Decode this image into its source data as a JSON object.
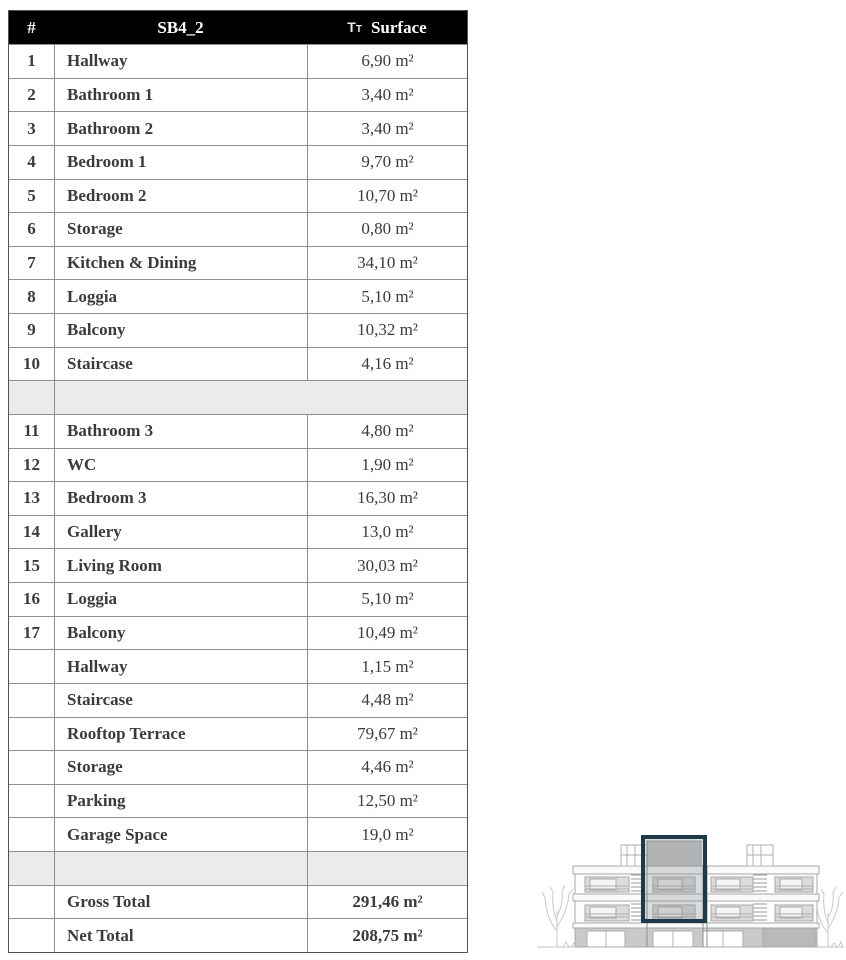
{
  "table": {
    "header": {
      "num": "#",
      "name": "SB4_2",
      "icon_big": "T",
      "icon_small": "T",
      "surface": "Surface"
    },
    "rows": [
      {
        "kind": "normal",
        "num": "1",
        "name": "Hallway",
        "surface": "6,90 m²"
      },
      {
        "kind": "normal",
        "num": "2",
        "name": "Bathroom 1",
        "surface": "3,40 m²"
      },
      {
        "kind": "normal",
        "num": "3",
        "name": "Bathroom 2",
        "surface": "3,40 m²"
      },
      {
        "kind": "normal",
        "num": "4",
        "name": "Bedroom 1",
        "surface": "9,70 m²"
      },
      {
        "kind": "normal",
        "num": "5",
        "name": "Bedroom 2",
        "surface": "10,70 m²"
      },
      {
        "kind": "normal",
        "num": "6",
        "name": "Storage",
        "surface": "0,80 m²"
      },
      {
        "kind": "normal",
        "num": "7",
        "name": "Kitchen & Dining",
        "surface": "34,10 m²"
      },
      {
        "kind": "normal",
        "num": "8",
        "name": "Loggia",
        "surface": "5,10 m²"
      },
      {
        "kind": "normal",
        "num": "9",
        "name": "Balcony",
        "surface": "10,32 m²"
      },
      {
        "kind": "normal",
        "num": "10",
        "name": "Staircase",
        "surface": "4,16 m²"
      },
      {
        "kind": "spacer",
        "variant": "a",
        "num": "",
        "name": "",
        "surface": ""
      },
      {
        "kind": "normal",
        "num": "11",
        "name": "Bathroom 3",
        "surface": "4,80 m²"
      },
      {
        "kind": "normal",
        "num": "12",
        "name": "WC",
        "surface": "1,90 m²"
      },
      {
        "kind": "normal",
        "num": "13",
        "name": "Bedroom 3",
        "surface": "16,30 m²"
      },
      {
        "kind": "normal",
        "num": "14",
        "name": "Gallery",
        "surface": "13,0 m²"
      },
      {
        "kind": "normal",
        "num": "15",
        "name": "Living Room",
        "surface": "30,03 m²"
      },
      {
        "kind": "normal",
        "num": "16",
        "name": "Loggia",
        "surface": "5,10 m²"
      },
      {
        "kind": "normal",
        "num": "17",
        "name": "Balcony",
        "surface": "10,49 m²"
      },
      {
        "kind": "normal",
        "num": "",
        "name": "Hallway",
        "surface": "1,15 m²"
      },
      {
        "kind": "normal",
        "num": "",
        "name": "Staircase",
        "surface": "4,48 m²"
      },
      {
        "kind": "normal",
        "num": "",
        "name": "Rooftop Terrace",
        "surface": "79,67 m²"
      },
      {
        "kind": "normal",
        "num": "",
        "name": "Storage",
        "surface": "4,46 m²"
      },
      {
        "kind": "normal",
        "num": "",
        "name": "Parking",
        "surface": "12,50 m²"
      },
      {
        "kind": "normal",
        "num": "",
        "name": "Garage Space",
        "surface": "19,0 m²"
      },
      {
        "kind": "spacer",
        "variant": "b",
        "num": "",
        "name": "",
        "surface": ""
      },
      {
        "kind": "total",
        "num": "",
        "name": "Gross Total",
        "surface": "291,46 m²"
      },
      {
        "kind": "total",
        "num": "",
        "name": "Net Total",
        "surface": "208,75 m²"
      }
    ]
  },
  "colors": {
    "header_bg": "#000000",
    "header_text": "#ffffff",
    "grid_line": "#8e8e8e",
    "spacer_bg": "#ebebeb",
    "body_text": "#3b3b3b",
    "highlight_accent": "#1d3a4a",
    "drawing_line": "#a8a8a8"
  }
}
